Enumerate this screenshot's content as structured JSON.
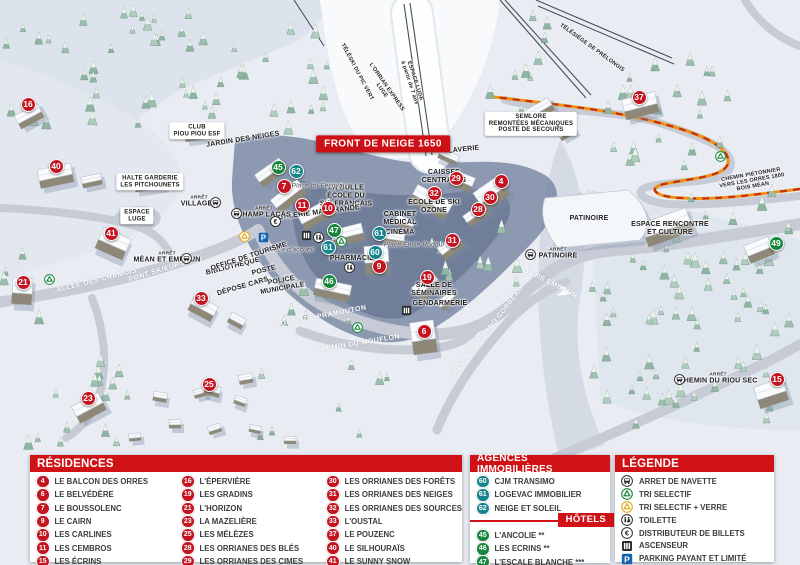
{
  "map": {
    "badges": [
      {
        "n": "16",
        "c": "red",
        "x": 28,
        "y": 104
      },
      {
        "n": "40",
        "c": "red",
        "x": 56,
        "y": 166
      },
      {
        "n": "41",
        "c": "red",
        "x": 111,
        "y": 233
      },
      {
        "n": "21",
        "c": "red",
        "x": 23,
        "y": 282
      },
      {
        "n": "33",
        "c": "red",
        "x": 201,
        "y": 298
      },
      {
        "n": "23",
        "c": "red",
        "x": 88,
        "y": 398
      },
      {
        "n": "25",
        "c": "red",
        "x": 209,
        "y": 384
      },
      {
        "n": "45",
        "c": "green",
        "x": 278,
        "y": 167
      },
      {
        "n": "62",
        "c": "teal",
        "x": 296,
        "y": 171
      },
      {
        "n": "7",
        "c": "red",
        "x": 284,
        "y": 186
      },
      {
        "n": "11",
        "c": "red",
        "x": 302,
        "y": 205
      },
      {
        "n": "10",
        "c": "red",
        "x": 328,
        "y": 208
      },
      {
        "n": "47",
        "c": "green",
        "x": 334,
        "y": 230
      },
      {
        "n": "61",
        "c": "teal",
        "x": 328,
        "y": 247
      },
      {
        "n": "61",
        "c": "teal",
        "x": 379,
        "y": 233
      },
      {
        "n": "60",
        "c": "teal",
        "x": 375,
        "y": 252
      },
      {
        "n": "9",
        "c": "red",
        "x": 379,
        "y": 266
      },
      {
        "n": "46",
        "c": "green",
        "x": 329,
        "y": 281
      },
      {
        "n": "29",
        "c": "red",
        "x": 456,
        "y": 178
      },
      {
        "n": "32",
        "c": "red",
        "x": 434,
        "y": 193
      },
      {
        "n": "4",
        "c": "red",
        "x": 501,
        "y": 181
      },
      {
        "n": "30",
        "c": "red",
        "x": 490,
        "y": 197
      },
      {
        "n": "28",
        "c": "red",
        "x": 478,
        "y": 209
      },
      {
        "n": "31",
        "c": "red",
        "x": 452,
        "y": 240
      },
      {
        "n": "19",
        "c": "red",
        "x": 427,
        "y": 277
      },
      {
        "n": "6",
        "c": "red",
        "x": 424,
        "y": 331
      },
      {
        "n": "37",
        "c": "red",
        "x": 639,
        "y": 97
      },
      {
        "n": "49",
        "c": "green",
        "x": 776,
        "y": 243
      },
      {
        "n": "15",
        "c": "red",
        "x": 777,
        "y": 379
      }
    ],
    "labels": [
      {
        "name": "front-de-neige-banner",
        "cls": "banner",
        "x": 383,
        "y": 144,
        "lines": [
          "FRONT DE NEIGE 1650"
        ]
      },
      {
        "cls": "box",
        "x": 137,
        "y": 216,
        "lines": [
          "ESPACE",
          "LUGE"
        ]
      },
      {
        "cls": "box",
        "x": 150,
        "y": 182,
        "lines": [
          "HALTE GARDERIE",
          "LES PITCHOUNETS"
        ]
      },
      {
        "cls": "box",
        "x": 531,
        "y": 124,
        "lines": [
          "SEMLORE",
          "REMONTÉES MÉCANIQUES",
          "POSTE DE SECOURS"
        ]
      },
      {
        "cls": "box",
        "x": 197,
        "y": 131,
        "lines": [
          "CLUB",
          "PIOU PIOU ESF"
        ]
      },
      {
        "cls": "poi",
        "x": 464,
        "y": 150,
        "rot": -6,
        "lines": [
          "LAVERIE"
        ]
      },
      {
        "cls": "poi",
        "x": 444,
        "y": 177,
        "lines": [
          "CAISSES",
          "CENTRALES"
        ]
      },
      {
        "cls": "poi",
        "x": 346,
        "y": 196,
        "lines": [
          "LA BULLE",
          "ÉCOLE DU",
          "SKI FRANÇAIS"
        ]
      },
      {
        "cls": "poi",
        "x": 434,
        "y": 207,
        "lines": [
          "ÉCOLE DE SKI",
          "OZONE"
        ]
      },
      {
        "cls": "poi",
        "x": 400,
        "y": 219,
        "lines": [
          "CABINET",
          "MÉDICAL"
        ]
      },
      {
        "cls": "poi",
        "x": 400,
        "y": 233,
        "lines": [
          "CINÉMA"
        ]
      },
      {
        "cls": "place",
        "x": 414,
        "y": 245,
        "lines": [
          "Place Émile Rodoul"
        ]
      },
      {
        "cls": "poi",
        "x": 352,
        "y": 259,
        "lines": [
          "PHARMACIE"
        ]
      },
      {
        "cls": "poi",
        "x": 319,
        "y": 213,
        "rot": -7,
        "lines": [
          "GALERIE MARCHANDE"
        ]
      },
      {
        "cls": "place",
        "x": 318,
        "y": 186,
        "lines": [
          "Place du Festival"
        ]
      },
      {
        "cls": "place",
        "x": 291,
        "y": 250,
        "lines": [
          "Place d'accueil"
        ]
      },
      {
        "cls": "poi",
        "x": 434,
        "y": 290,
        "lines": [
          "SALLE DE",
          "SÉMINAIRES"
        ]
      },
      {
        "cls": "poi",
        "x": 440,
        "y": 304,
        "lines": [
          "GENDARMERIE"
        ]
      },
      {
        "cls": "poi",
        "x": 589,
        "y": 219,
        "lines": [
          "PATINOIRE"
        ]
      },
      {
        "cls": "poi",
        "x": 670,
        "y": 229,
        "lines": [
          "ESPACE RENCONTRE",
          "ET CULTURE"
        ]
      },
      {
        "cls": "poi",
        "x": 233,
        "y": 267,
        "rot": -14,
        "lines": [
          "BIBLIOTHÈQUE"
        ]
      },
      {
        "cls": "poi",
        "x": 249,
        "y": 257,
        "rot": -18,
        "lines": [
          "OFFICE DE TOURISME"
        ]
      },
      {
        "cls": "poi",
        "x": 264,
        "y": 271,
        "rot": -14,
        "lines": [
          "POSTE"
        ]
      },
      {
        "cls": "poi",
        "x": 282,
        "y": 285,
        "rot": -10,
        "lines": [
          "POLICE",
          "MUNICIPALE"
        ]
      },
      {
        "cls": "poi",
        "x": 243,
        "y": 287,
        "rot": -16,
        "lines": [
          "DÉPOSE CARS"
        ]
      },
      {
        "cls": "poi",
        "x": 243,
        "y": 140,
        "rot": -9,
        "lines": [
          "JARDIN DES NEIGES"
        ]
      },
      {
        "cls": "tiny",
        "x": 752,
        "y": 181,
        "rot": -10,
        "lines": [
          "CHEMIN PIÉTONNIER",
          "VERS LES ORRES 1800",
          "BOIS MÉAN"
        ]
      },
      {
        "name": "bus-stop-label",
        "cls": "stop",
        "x": 199,
        "y": 202,
        "lines": [
          "ARRÊT",
          "VILLAGES"
        ]
      },
      {
        "name": "bus-stop-label",
        "cls": "stop",
        "x": 264,
        "y": 213,
        "lines": [
          "ARRÊT",
          "CHAMP LACAS"
        ]
      },
      {
        "name": "bus-stop-label",
        "cls": "stop",
        "x": 167,
        "y": 258,
        "lines": [
          "ARRÊT",
          "MÉAN ET EMBRUN"
        ]
      },
      {
        "name": "bus-stop-label",
        "cls": "stop",
        "x": 558,
        "y": 254,
        "lines": [
          "ARRÊT",
          "PATINOIRE"
        ]
      },
      {
        "name": "bus-stop-label",
        "cls": "stop",
        "x": 718,
        "y": 379,
        "lines": [
          "ARRÊT",
          "CHEMIN DU RIOU SEC"
        ]
      },
      {
        "name": "road-label",
        "cls": "road",
        "x": 157,
        "y": 272,
        "rot": -17,
        "lines": [
          "PONT SKIEURS"
        ]
      },
      {
        "name": "road-label",
        "cls": "road",
        "x": 97,
        "y": 281,
        "rot": -14,
        "lines": [
          "ALLÉE DES CHAMOIS"
        ]
      },
      {
        "name": "road-label",
        "cls": "road",
        "x": 321,
        "y": 317,
        "rot": -11,
        "lines": [
          "ROUTE DE PRAMOUTON"
        ]
      },
      {
        "name": "road-label",
        "cls": "road",
        "x": 358,
        "y": 344,
        "rot": -9,
        "lines": [
          "CHEMIN DU MOUFLON"
        ]
      },
      {
        "name": "road-label",
        "cls": "road",
        "x": 487,
        "y": 333,
        "rot": -52,
        "lines": [
          "CHEMIN DU GRAND CORBEAU"
        ]
      },
      {
        "name": "road-label",
        "cls": "road",
        "x": 551,
        "y": 284,
        "rot": 27,
        "lines": [
          "VERS EMBRUN"
        ]
      },
      {
        "cls": "tiny",
        "x": 357,
        "y": 72,
        "rot": 62,
        "lines": [
          "TÉLÉSKI DU PIC VERT"
        ]
      },
      {
        "cls": "tiny",
        "x": 384,
        "y": 89,
        "rot": 55,
        "lines": [
          "L'ORRIAN EXPRESS",
          "LUGE"
        ]
      },
      {
        "cls": "tiny",
        "x": 592,
        "y": 48,
        "rot": 36,
        "lines": [
          "TÉLÉSIÈGE DE PRÉLONGIS"
        ]
      },
      {
        "cls": "tiny",
        "x": 412,
        "y": 82,
        "rot": 72,
        "lines": [
          "ESPACE LUGE",
          "à partir de 7 ans"
        ]
      }
    ],
    "icons": [
      {
        "name": "bus",
        "x": 215,
        "y": 202
      },
      {
        "name": "bus",
        "x": 236,
        "y": 213
      },
      {
        "name": "bus",
        "x": 186,
        "y": 258
      },
      {
        "name": "bus",
        "x": 530,
        "y": 254
      },
      {
        "name": "bus",
        "x": 679,
        "y": 379
      },
      {
        "name": "euro",
        "x": 275,
        "y": 221
      },
      {
        "name": "recycle-yellow",
        "x": 244,
        "y": 236
      },
      {
        "name": "parking",
        "x": 263,
        "y": 237
      },
      {
        "name": "elevator",
        "x": 306,
        "y": 235
      },
      {
        "name": "wc",
        "x": 318,
        "y": 237
      },
      {
        "name": "wc",
        "x": 349,
        "y": 267
      },
      {
        "name": "elevator",
        "x": 406,
        "y": 310
      },
      {
        "name": "recycle-green",
        "x": 49,
        "y": 279
      },
      {
        "name": "recycle-green",
        "x": 341,
        "y": 241
      },
      {
        "name": "recycle-green",
        "x": 357,
        "y": 327
      },
      {
        "name": "recycle-green",
        "x": 720,
        "y": 156
      }
    ]
  },
  "panels": {
    "residences": {
      "title": "RÉSIDENCES",
      "columns": [
        [
          {
            "n": "4",
            "label": "LE BALCON DES ORRES"
          },
          {
            "n": "6",
            "label": "LE BELVÉDÈRE"
          },
          {
            "n": "7",
            "label": "LE BOUSSOLENC"
          },
          {
            "n": "9",
            "label": "LE CAIRN"
          },
          {
            "n": "10",
            "label": "LES CARLINES"
          },
          {
            "n": "11",
            "label": "LES CEMBROS"
          },
          {
            "n": "15",
            "label": "LES ÉCRINS"
          }
        ],
        [
          {
            "n": "16",
            "label": "L'ÉPERVIÈRE"
          },
          {
            "n": "19",
            "label": "LES GRADINS"
          },
          {
            "n": "21",
            "label": "L'HORIZON"
          },
          {
            "n": "23",
            "label": "LA MAZELIÈRE"
          },
          {
            "n": "25",
            "label": "LES MÉLÈZES"
          },
          {
            "n": "28",
            "label": "LES ORRIANES DES BLÉS"
          },
          {
            "n": "29",
            "label": "LES ORRIANES DES CIMES"
          }
        ],
        [
          {
            "n": "30",
            "label": "LES ORRIANES DES FORÊTS"
          },
          {
            "n": "31",
            "label": "LES ORRIANES DES NEIGES"
          },
          {
            "n": "32",
            "label": "LES ORRIANES DES SOURCES"
          },
          {
            "n": "33",
            "label": "L'OUSTAL"
          },
          {
            "n": "37",
            "label": "LE POUZENC"
          },
          {
            "n": "40",
            "label": "LE SILHOURAÏS"
          },
          {
            "n": "41",
            "label": "LE SUNNY SNOW"
          }
        ]
      ]
    },
    "agences": {
      "title": "AGENCES IMMOBILIÈRES",
      "items": [
        {
          "n": "60",
          "label": "CJM TRANSIMO"
        },
        {
          "n": "61",
          "label": "LOGEVAC IMMOBILIER"
        },
        {
          "n": "62",
          "label": "NEIGE ET SOLEIL"
        }
      ]
    },
    "hotels": {
      "title": "HÔTELS",
      "items": [
        {
          "n": "45",
          "label": "L'ANCOLIE **"
        },
        {
          "n": "46",
          "label": "LES ECRINS **"
        },
        {
          "n": "47",
          "label": "L'ESCALE BLANCHE ***"
        },
        {
          "n": "49",
          "label": "LES TRAPPEURS **"
        }
      ]
    },
    "legende": {
      "title": "LÉGENDE",
      "items": [
        {
          "icon": "bus",
          "label": "ARRET DE NAVETTE"
        },
        {
          "icon": "recycle-green",
          "label": "TRI SELECTIF"
        },
        {
          "icon": "recycle-yellow",
          "label": "TRI SELECTIF + VERRE"
        },
        {
          "icon": "wc",
          "label": "TOILETTE"
        },
        {
          "icon": "euro",
          "label": "DISTRIBUTEUR DE BILLETS"
        },
        {
          "icon": "elevator",
          "label": "ASCENSEUR"
        },
        {
          "icon": "parking",
          "label": "PARKING PAYANT ET LIMITÉ"
        }
      ]
    }
  },
  "colors": {
    "badge_red": "#c41420",
    "badge_green": "#15863c",
    "badge_teal": "#16848c",
    "header_red": "#d01217",
    "parking_blue": "#1563ae",
    "path_orange": "#f09418",
    "path_red": "#c3310f"
  }
}
